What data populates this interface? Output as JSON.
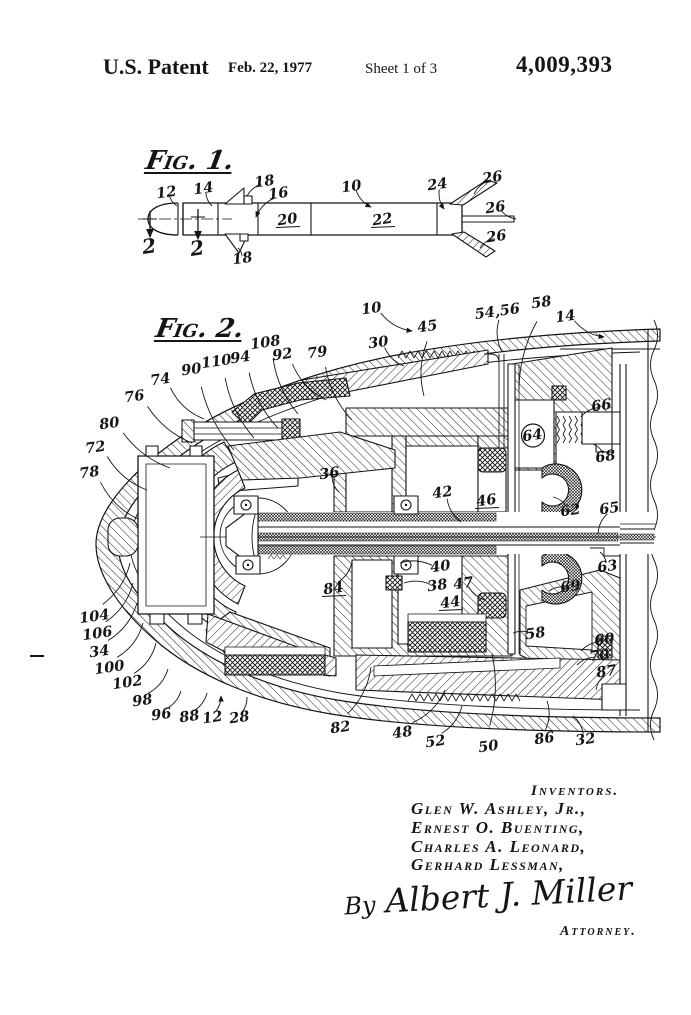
{
  "colors": {
    "ink": "#151515",
    "paper": "#ffffff"
  },
  "header": {
    "title": "U.S. Patent",
    "date": "Feb. 22, 1977",
    "sheet": "Sheet 1 of 3",
    "patent_number": "4,009,393"
  },
  "fig1": {
    "title": "Fig. 1.",
    "labels": [
      {
        "t": "12",
        "x": 167,
        "y": 197,
        "l": [
          177,
          206
        ]
      },
      {
        "t": "14",
        "x": 204,
        "y": 193,
        "l": [
          212,
          206
        ]
      },
      {
        "t": "18",
        "x": 265,
        "y": 186,
        "l": [
          247,
          196
        ]
      },
      {
        "t": "16",
        "x": 279,
        "y": 198,
        "l": [
          256,
          217
        ],
        "arrow": true
      },
      {
        "t": "10",
        "x": 352,
        "y": 191,
        "l": [
          371,
          207
        ],
        "arrow": true
      },
      {
        "t": "24",
        "x": 438,
        "y": 189,
        "l": [
          444,
          209
        ],
        "arrow": true
      },
      {
        "t": "26",
        "x": 493,
        "y": 182,
        "l": [
          474,
          194
        ]
      },
      {
        "t": "26",
        "x": 496,
        "y": 212,
        "l": [
          516,
          219
        ]
      },
      {
        "t": "26",
        "x": 497,
        "y": 241,
        "l": [
          480,
          248
        ]
      },
      {
        "t": "20",
        "x": 288,
        "y": 224,
        "u": true
      },
      {
        "t": "22",
        "x": 383,
        "y": 224,
        "u": true
      },
      {
        "t": "18",
        "x": 243,
        "y": 263,
        "l": [
          238,
          248
        ]
      },
      {
        "t": "2",
        "x": 150,
        "y": 253,
        "big": true
      },
      {
        "t": "2",
        "x": 198,
        "y": 255,
        "big": true
      }
    ]
  },
  "fig2": {
    "title": "Fig. 2.",
    "labels": [
      {
        "t": "10",
        "x": 372,
        "y": 313,
        "l": [
          412,
          331
        ],
        "arrow": true
      },
      {
        "t": "45",
        "x": 428,
        "y": 331,
        "l": [
          424,
          396
        ]
      },
      {
        "t": "30",
        "x": 379,
        "y": 347,
        "l": [
          404,
          366
        ]
      },
      {
        "t": "54,56",
        "x": 498,
        "y": 316,
        "l": [
          502,
          352
        ]
      },
      {
        "t": "58",
        "x": 542,
        "y": 307,
        "l": [
          519,
          390
        ]
      },
      {
        "t": "14",
        "x": 566,
        "y": 321,
        "l": [
          604,
          337
        ],
        "arrow": true
      },
      {
        "t": "79",
        "x": 318,
        "y": 357,
        "l": [
          352,
          420
        ]
      },
      {
        "t": "92",
        "x": 283,
        "y": 359,
        "l": [
          326,
          400
        ]
      },
      {
        "t": "108",
        "x": 266,
        "y": 347,
        "l": [
          298,
          414
        ]
      },
      {
        "t": "94",
        "x": 241,
        "y": 362,
        "l": [
          278,
          428
        ]
      },
      {
        "t": "110",
        "x": 217,
        "y": 366,
        "l": [
          254,
          438
        ]
      },
      {
        "t": "90",
        "x": 192,
        "y": 374,
        "l": [
          234,
          450
        ]
      },
      {
        "t": "74",
        "x": 161,
        "y": 384,
        "l": [
          204,
          419
        ]
      },
      {
        "t": "76",
        "x": 135,
        "y": 401,
        "l": [
          192,
          443
        ]
      },
      {
        "t": "80",
        "x": 110,
        "y": 428,
        "l": [
          170,
          468
        ]
      },
      {
        "t": "72",
        "x": 96,
        "y": 452,
        "l": [
          147,
          490
        ]
      },
      {
        "t": "78",
        "x": 90,
        "y": 477,
        "l": [
          138,
          519
        ]
      },
      {
        "t": "66",
        "x": 602,
        "y": 410,
        "l": [
          581,
          417
        ]
      },
      {
        "t": "64",
        "x": 533,
        "y": 440,
        "circled": true
      },
      {
        "t": "68",
        "x": 606,
        "y": 461,
        "l": [
          593,
          444
        ]
      },
      {
        "t": "36",
        "x": 330,
        "y": 478,
        "l": [
          339,
          492
        ]
      },
      {
        "t": "42",
        "x": 443,
        "y": 497,
        "l": [
          461,
          522
        ]
      },
      {
        "t": "46",
        "x": 487,
        "y": 505,
        "u": true
      },
      {
        "t": "62",
        "x": 571,
        "y": 515,
        "l": [
          553,
          497
        ]
      },
      {
        "t": "65",
        "x": 610,
        "y": 513,
        "l": [
          598,
          534
        ]
      },
      {
        "t": "63",
        "x": 608,
        "y": 571,
        "l": [
          600,
          552
        ]
      },
      {
        "t": "40",
        "x": 441,
        "y": 571,
        "l": [
          400,
          563
        ]
      },
      {
        "t": "38",
        "x": 438,
        "y": 590,
        "l": [
          404,
          583
        ]
      },
      {
        "t": "47",
        "x": 464,
        "y": 588,
        "l": [
          485,
          600
        ]
      },
      {
        "t": "44",
        "x": 451,
        "y": 607,
        "u": true
      },
      {
        "t": "69",
        "x": 571,
        "y": 591,
        "l": [
          549,
          591
        ]
      },
      {
        "t": "84",
        "x": 334,
        "y": 593,
        "u": true,
        "l": [
          352,
          562
        ]
      },
      {
        "t": "58",
        "x": 536,
        "y": 638,
        "l": [
          513,
          633
        ]
      },
      {
        "t": "60",
        "x": 605,
        "y": 644,
        "l": [
          581,
          651
        ]
      },
      {
        "t": "70",
        "x": 600,
        "y": 660,
        "l": [
          577,
          665
        ]
      },
      {
        "t": "87",
        "x": 607,
        "y": 676,
        "l": [
          596,
          690
        ]
      },
      {
        "t": "104",
        "x": 95,
        "y": 621,
        "l": [
          130,
          563
        ]
      },
      {
        "t": "106",
        "x": 98,
        "y": 638,
        "l": [
          133,
          583
        ]
      },
      {
        "t": "34",
        "x": 100,
        "y": 656,
        "l": [
          137,
          603
        ]
      },
      {
        "t": "100",
        "x": 110,
        "y": 672,
        "l": [
          143,
          623
        ]
      },
      {
        "t": "102",
        "x": 128,
        "y": 687,
        "l": [
          156,
          643
        ]
      },
      {
        "t": "98",
        "x": 143,
        "y": 705,
        "l": [
          168,
          669
        ]
      },
      {
        "t": "96",
        "x": 162,
        "y": 719,
        "l": [
          181,
          691
        ]
      },
      {
        "t": "88",
        "x": 190,
        "y": 721,
        "l": [
          207,
          693
        ]
      },
      {
        "t": "12",
        "x": 213,
        "y": 722,
        "l": [
          221,
          696
        ],
        "arrow": true
      },
      {
        "t": "28",
        "x": 240,
        "y": 722,
        "l": [
          247,
          697
        ]
      },
      {
        "t": "82",
        "x": 341,
        "y": 732,
        "l": [
          371,
          667
        ]
      },
      {
        "t": "48",
        "x": 403,
        "y": 737,
        "l": [
          445,
          690
        ]
      },
      {
        "t": "52",
        "x": 436,
        "y": 746,
        "l": [
          462,
          706
        ]
      },
      {
        "t": "50",
        "x": 489,
        "y": 751,
        "l": [
          492,
          654
        ]
      },
      {
        "t": "86",
        "x": 545,
        "y": 743,
        "l": [
          547,
          701
        ]
      },
      {
        "t": "32",
        "x": 586,
        "y": 744,
        "l": [
          573,
          716
        ]
      }
    ]
  },
  "signature": {
    "heading": "Inventors.",
    "names": [
      "Glen W. Ashley, Jr.,",
      "Ernest O. Buenting,",
      "Charles A. Leonard,",
      "Gerhard Lessman,"
    ],
    "by": "By",
    "signed": "Albert J. Miller",
    "attorney": "Attorney."
  }
}
